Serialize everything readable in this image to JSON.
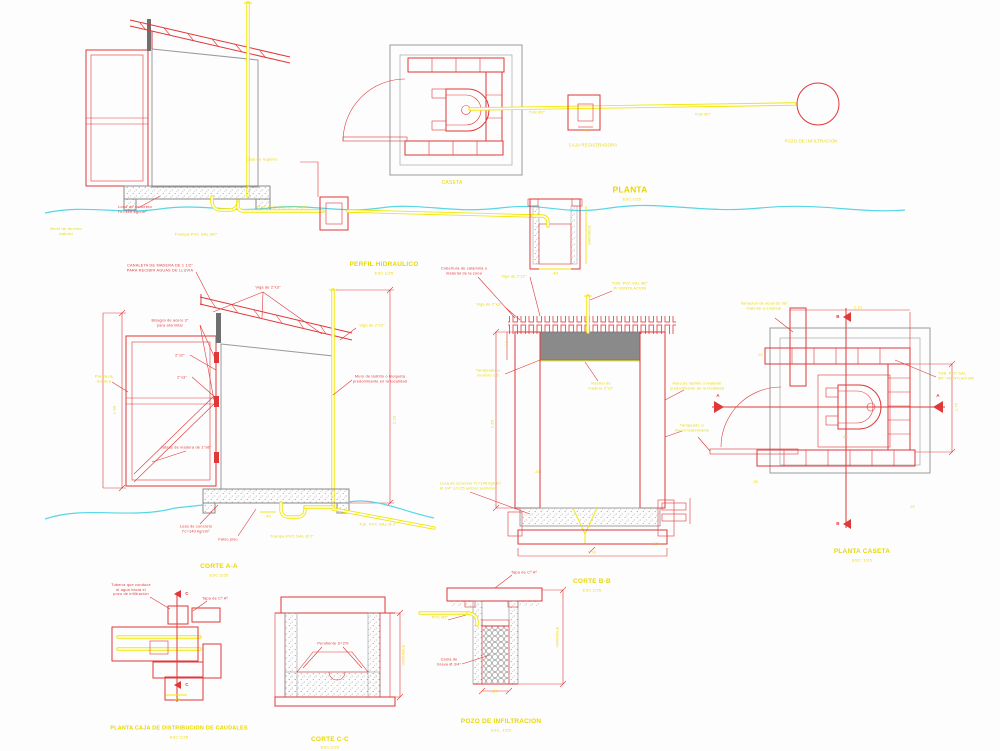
{
  "colors": {
    "red": "#e03838",
    "yellow": "#d6b800",
    "yellow_bright": "#f2e600",
    "cyan": "#57d6e6",
    "gray": "#9a9a9a",
    "slab_gray": "#8a8a8a",
    "wood_dark": "#6f6f6f",
    "background": "#fdfdfe"
  },
  "labels": [
    {
      "id": "losa-elev-label",
      "text": "Losa de concreto\nf'c=140 kg/cm²",
      "x": 118,
      "y": 209,
      "color": "red",
      "size": 4,
      "align": "left"
    },
    {
      "id": "trampa-elev-label",
      "text": "Trampa PVC SAL Ø2\"",
      "x": 196,
      "y": 234,
      "color": "yellow",
      "size": 4
    },
    {
      "id": "tub-elev-label",
      "text": "TUB. PVC SAL Ø2\"  S=2%",
      "x": 282,
      "y": 207,
      "color": "yellow",
      "size": 4
    },
    {
      "id": "caja-registro-elev-label",
      "text": "Caja de registro",
      "x": 262,
      "y": 159,
      "color": "yellow",
      "size": 4
    },
    {
      "id": "terreno-natural-label",
      "text": "Nivel de terreno\nnatural",
      "x": 66,
      "y": 231,
      "color": "yellow",
      "size": 4
    },
    {
      "id": "perfil-title",
      "text": "PERFIL HIDRAULICO",
      "x": 384,
      "y": 265,
      "color": "yellow",
      "size": 6.5,
      "bold": true
    },
    {
      "id": "perfil-scale",
      "text": "ESC 1/25",
      "x": 384,
      "y": 273,
      "color": "yellow",
      "size": 4
    },
    {
      "id": "perfil-pozo-dim",
      "text": ".40",
      "x": 555,
      "y": 273,
      "color": "yellow",
      "size": 4
    },
    {
      "id": "perfil-pozo-variable",
      "text": "VARIABLE",
      "x": 590,
      "y": 235,
      "color": "yellow",
      "size": 3.8,
      "rot": -90
    },
    {
      "id": "caseta-label",
      "text": "CASETA",
      "x": 452,
      "y": 183,
      "color": "yellow",
      "size": 5
    },
    {
      "id": "planta-title",
      "text": "PLANTA",
      "x": 630,
      "y": 190,
      "color": "yellow",
      "size": 8.5,
      "bold": true
    },
    {
      "id": "planta-scale",
      "text": "ESC 1/25",
      "x": 632,
      "y": 199,
      "color": "yellow",
      "size": 4
    },
    {
      "id": "caja-registradora-label",
      "text": "CAJA REGISTRADORA",
      "x": 593,
      "y": 145,
      "color": "yellow",
      "size": 4.2
    },
    {
      "id": "caja-registradora-dim",
      "text": ".40",
      "x": 586,
      "y": 131,
      "color": "yellow",
      "size": 3.8
    },
    {
      "id": "tub-planta-label-1",
      "text": "TUB Ø2\"",
      "x": 537,
      "y": 113,
      "color": "yellow",
      "size": 3.8
    },
    {
      "id": "tub-planta-label-2",
      "text": "TUB Ø2\"",
      "x": 703,
      "y": 115,
      "color": "yellow",
      "size": 3.8
    },
    {
      "id": "pozo-circulo-label",
      "text": "POZO DE INFILTRACION",
      "x": 811,
      "y": 141,
      "color": "yellow",
      "size": 4.2
    },
    {
      "id": "canaleta-label",
      "text": "CANALETA DE MADERA DE 1 1/2\"\nPARA RECIBIR AGUAS DE LLUVIA",
      "x": 160,
      "y": 268,
      "color": "red",
      "size": 3.8
    },
    {
      "id": "viga-aa-label",
      "text": "Viga de 2\"x3\"",
      "x": 268,
      "y": 288,
      "color": "red",
      "size": 3.8
    },
    {
      "id": "bisagra-label",
      "text": "Bisagra de acero 3\"\npara atornillar",
      "x": 170,
      "y": 323,
      "color": "red",
      "size": 3.8
    },
    {
      "id": "liston-label-1",
      "text": "2\"x2\"",
      "x": 180,
      "y": 356,
      "color": "red",
      "size": 3.8
    },
    {
      "id": "liston-label-2",
      "text": "2\"x3\"",
      "x": 182,
      "y": 378,
      "color": "red",
      "size": 3.8
    },
    {
      "id": "puerta-aa-label",
      "text": "Puerta de\nmadera",
      "x": 104,
      "y": 379,
      "color": "yellow",
      "size": 3.8
    },
    {
      "id": "tablas-label",
      "text": "Tablas de madera de 1\"x8\"",
      "x": 186,
      "y": 448,
      "color": "red",
      "size": 3.8
    },
    {
      "id": "dim-aa-left",
      "text": "1.90",
      "x": 114,
      "y": 410,
      "color": "yellow",
      "size": 4,
      "rot": -90
    },
    {
      "id": "dim-aa-right",
      "text": "2.20",
      "x": 394,
      "y": 420,
      "color": "yellow",
      "size": 4,
      "rot": -90
    },
    {
      "id": "muro-aa-label",
      "text": "Muro de ladrillo o bloqueta\npredominante en la localidad",
      "x": 380,
      "y": 379,
      "color": "red",
      "size": 3.8
    },
    {
      "id": "viga-aa-label-2",
      "text": "Viga de 2\"x3\"",
      "x": 372,
      "y": 326,
      "color": "yellow",
      "size": 3.8
    },
    {
      "id": "losa-aa-label",
      "text": "Losa de concreto\nf'c=140 kg/cm²",
      "x": 196,
      "y": 529,
      "color": "red",
      "size": 3.8
    },
    {
      "id": "falso-piso-label",
      "text": "Falso piso",
      "x": 228,
      "y": 540,
      "color": "red",
      "size": 3.8
    },
    {
      "id": "trampa-aa-label",
      "text": "Trampa PVC SAL Ø 2\"",
      "x": 292,
      "y": 536,
      "color": "yellow",
      "size": 4
    },
    {
      "id": "tub-aa-label",
      "text": "Tub. PVC SAL Ø 2\"",
      "x": 378,
      "y": 524,
      "color": "yellow",
      "size": 4
    },
    {
      "id": "dim-aa-40",
      "text": ".40",
      "x": 268,
      "y": 517,
      "color": "yellow",
      "size": 3.8
    },
    {
      "id": "corte-aa-title",
      "text": "CORTE A-A",
      "x": 219,
      "y": 567,
      "color": "yellow",
      "size": 6.5,
      "bold": true
    },
    {
      "id": "corte-aa-scale",
      "text": "ESC:1/25",
      "x": 219,
      "y": 575,
      "color": "yellow",
      "size": 4
    },
    {
      "id": "cobertura-bb-label",
      "text": "Cobertura de calamina o\nmaterial de la zona",
      "x": 464,
      "y": 271,
      "color": "red",
      "size": 3.8
    },
    {
      "id": "viga-bb-label",
      "text": "Viga de 2\"x2\"",
      "x": 514,
      "y": 277,
      "color": "yellow",
      "size": 3.8
    },
    {
      "id": "correa-bb-label",
      "text": "Viga de 2\"x2\"",
      "x": 489,
      "y": 305,
      "color": "yellow",
      "size": 3.8
    },
    {
      "id": "tub-vent-bb-label",
      "text": "TUB. PVC SAL Ø2\"\nP/ VENTILACION",
      "x": 630,
      "y": 286,
      "color": "yellow",
      "size": 3.8
    },
    {
      "id": "tarrajeo-bb-label",
      "text": "Tarrajeado c/\nmortero 1:5",
      "x": 488,
      "y": 373,
      "color": "yellow",
      "size": 3.8
    },
    {
      "id": "rastrel-bb-label",
      "text": "Rastrel de\nmadera 2\"x2\"",
      "x": 601,
      "y": 386,
      "color": "yellow",
      "size": 3.8
    },
    {
      "id": "muro-bb-label",
      "text": "Muro de ladrillo o material\npredominante de la localidad",
      "x": 697,
      "y": 386,
      "color": "yellow",
      "size": 3.8
    },
    {
      "id": "tarrajeo2-bb-label",
      "text": "Tarrajeado c/\nimpermeabilizante",
      "x": 692,
      "y": 428,
      "color": "yellow",
      "size": 3.8
    },
    {
      "id": "losa-bb-label",
      "text": "Losa de concreto f'c=140 kg/cm²\nØ 1/4\" c/0.25 ambos sentidos",
      "x": 440,
      "y": 486,
      "color": "yellow",
      "size": 3.8,
      "align": "left"
    },
    {
      "id": "dim-bb-150",
      "text": "1.50",
      "x": 492,
      "y": 424,
      "color": "yellow",
      "size": 4,
      "rot": -90
    },
    {
      "id": "dim-bb-40",
      "text": ".40",
      "x": 507,
      "y": 344,
      "color": "yellow",
      "size": 3.5,
      "rot": -90
    },
    {
      "id": "dim-bb-20",
      "text": ".20",
      "x": 537,
      "y": 472,
      "color": "yellow",
      "size": 3.5
    },
    {
      "id": "dim-bb-120",
      "text": "1.20",
      "x": 592,
      "y": 552,
      "color": "yellow",
      "size": 4
    },
    {
      "id": "dim-bb-25",
      "text": ".25",
      "x": 656,
      "y": 544,
      "color": "yellow",
      "size": 3.5
    },
    {
      "id": "corte-bb-title",
      "text": "CORTE B-B",
      "x": 592,
      "y": 582,
      "color": "yellow",
      "size": 6.5,
      "bold": true
    },
    {
      "id": "corte-bb-scale",
      "text": "ESC:1/25",
      "x": 592,
      "y": 590,
      "color": "yellow",
      "size": 4
    },
    {
      "id": "variacion-label",
      "text": "Variación de acuerdo del\nmaterial a emplear",
      "x": 764,
      "y": 306,
      "color": "yellow",
      "size": 3.8
    },
    {
      "id": "tub-vent-pc-label",
      "text": "TUB. PVC SAL\nØ2\" VENTILACION",
      "x": 938,
      "y": 376,
      "color": "yellow",
      "size": 3.8,
      "align": "left"
    },
    {
      "id": "dim-pc-110",
      "text": "1.10",
      "x": 858,
      "y": 308,
      "color": "yellow",
      "size": 3.8
    },
    {
      "id": "dim-pc-170",
      "text": "1.70",
      "x": 957,
      "y": 407,
      "color": "yellow",
      "size": 3.8,
      "rot": -90
    },
    {
      "id": "dim-pc-20",
      "text": ".20",
      "x": 760,
      "y": 355,
      "color": "yellow",
      "size": 3.5
    },
    {
      "id": "dim-pc-60",
      "text": ".60",
      "x": 845,
      "y": 437,
      "color": "yellow",
      "size": 3.5
    },
    {
      "id": "dim-pc-25a",
      "text": ".25",
      "x": 755,
      "y": 482,
      "color": "yellow",
      "size": 3.5
    },
    {
      "id": "dim-pc-25b",
      "text": ".25",
      "x": 912,
      "y": 507,
      "color": "yellow",
      "size": 3.5
    },
    {
      "id": "marker-a-left",
      "text": "A",
      "x": 718,
      "y": 396,
      "color": "red",
      "size": 4.5,
      "bold": true
    },
    {
      "id": "marker-a-right",
      "text": "A",
      "x": 938,
      "y": 396,
      "color": "red",
      "size": 4.5,
      "bold": true
    },
    {
      "id": "marker-b-top",
      "text": "B",
      "x": 838,
      "y": 317,
      "color": "red",
      "size": 4.5,
      "bold": true
    },
    {
      "id": "marker-b-bottom",
      "text": "B",
      "x": 838,
      "y": 524,
      "color": "red",
      "size": 4.5,
      "bold": true
    },
    {
      "id": "planta-caseta-title",
      "text": "PLANTA CASETA",
      "x": 862,
      "y": 552,
      "color": "yellow",
      "size": 6.5,
      "bold": true
    },
    {
      "id": "planta-caseta-scale",
      "text": "ESC: 1/25",
      "x": 862,
      "y": 560,
      "color": "yellow",
      "size": 4
    },
    {
      "id": "caja-leader-label",
      "text": "Tubería que conduce\nel agua hacia el\npozo de infiltración",
      "x": 131,
      "y": 590,
      "color": "red",
      "size": 3.8
    },
    {
      "id": "tapa-caja-label",
      "text": "Tapa de Cº Aº",
      "x": 215,
      "y": 599,
      "color": "red",
      "size": 3.8
    },
    {
      "id": "marker-c-top",
      "text": "C",
      "x": 187,
      "y": 594,
      "color": "red",
      "size": 4.5,
      "bold": true
    },
    {
      "id": "marker-c-bottom",
      "text": "C",
      "x": 187,
      "y": 685,
      "color": "red",
      "size": 4.5,
      "bold": true
    },
    {
      "id": "dim-caja",
      "text": ".40",
      "x": 177,
      "y": 700,
      "color": "yellow",
      "size": 3.8
    },
    {
      "id": "planta-caja-title",
      "text": "PLANTA CAJA DE DISTRIBUCION DE CAUDALES",
      "x": 179,
      "y": 729,
      "color": "yellow",
      "size": 5.5,
      "bold": true
    },
    {
      "id": "planta-caja-scale",
      "text": "ESC:1/25",
      "x": 179,
      "y": 737,
      "color": "yellow",
      "size": 4
    },
    {
      "id": "pendiente-cc-label",
      "text": "Pendiente S=2%",
      "x": 333,
      "y": 644,
      "color": "red",
      "size": 3.8
    },
    {
      "id": "variable-cc",
      "text": "VARIABLE",
      "x": 403,
      "y": 655,
      "color": "yellow",
      "size": 4,
      "rot": -90
    },
    {
      "id": "corte-cc-title",
      "text": "CORTE C-C",
      "x": 330,
      "y": 740,
      "color": "yellow",
      "size": 6.5,
      "bold": true
    },
    {
      "id": "corte-cc-scale",
      "text": "ESC:1/25",
      "x": 330,
      "y": 747,
      "color": "yellow",
      "size": 4
    },
    {
      "id": "tapa-pozo-label",
      "text": "Tapa de Cº Aº",
      "x": 524,
      "y": 573,
      "color": "red",
      "size": 3.8
    },
    {
      "id": "pvc-pozo-label",
      "text": "PVC Ø2\"",
      "x": 440,
      "y": 618,
      "color": "yellow",
      "size": 3.8
    },
    {
      "id": "grava-pozo-label",
      "text": "Cama de\nGrava Ø 3/4\"",
      "x": 449,
      "y": 662,
      "color": "red",
      "size": 3.8
    },
    {
      "id": "variable-pozo",
      "text": "VARIABLE",
      "x": 557,
      "y": 637,
      "color": "yellow",
      "size": 4,
      "rot": -90
    },
    {
      "id": "dim-pozo",
      "text": ".80",
      "x": 495,
      "y": 692,
      "color": "yellow",
      "size": 3.8
    },
    {
      "id": "pozo-title",
      "text": "POZO DE INFILTRACION",
      "x": 501,
      "y": 722,
      "color": "yellow",
      "size": 6.5,
      "bold": true
    },
    {
      "id": "pozo-scale",
      "text": "ESC. 1/25",
      "x": 501,
      "y": 730,
      "color": "yellow",
      "size": 4
    }
  ]
}
